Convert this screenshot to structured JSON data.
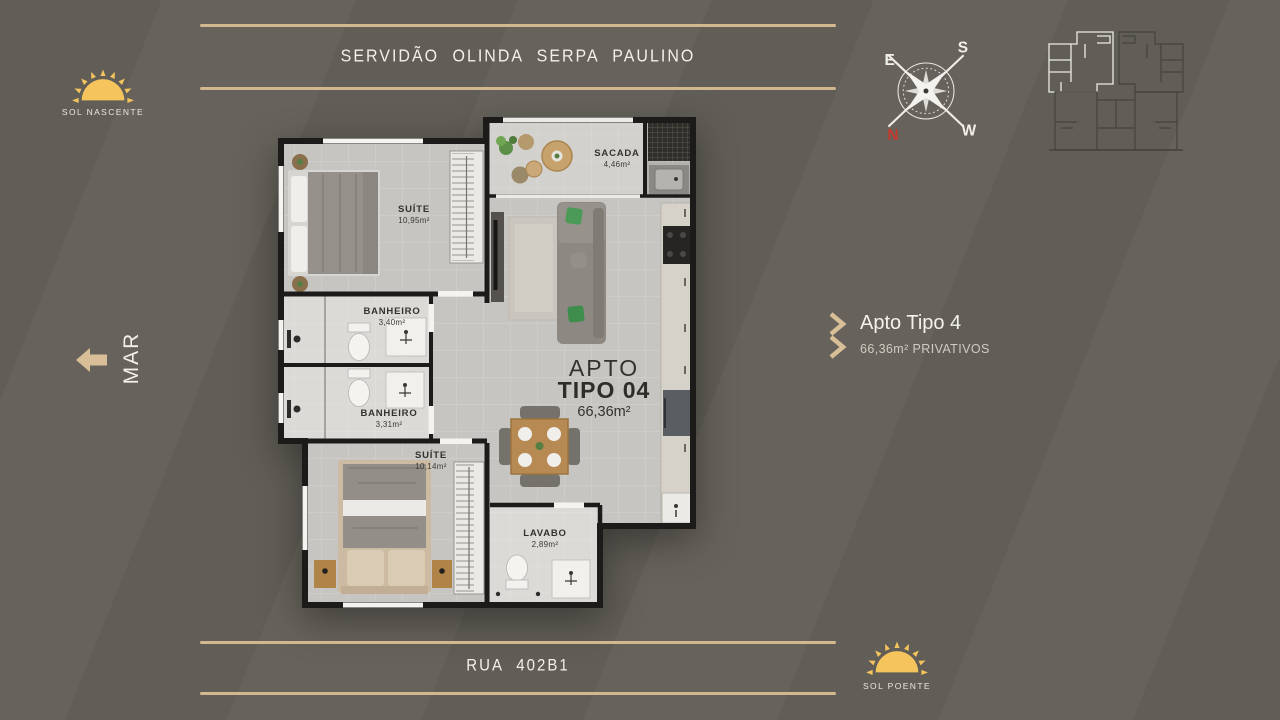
{
  "header": {
    "street": "SERVIDÃO OLINDA SERPA PAULINO"
  },
  "footer": {
    "street": "RUA 402B1"
  },
  "suns": {
    "nascente": "SOL NASCENTE",
    "poente": "SOL POENTE"
  },
  "sea": {
    "label": "MAR"
  },
  "compass": {
    "e": "E",
    "s": "S",
    "w": "W",
    "n": "N"
  },
  "info": {
    "title": "Apto Tipo 4",
    "subtitle": "66,36m² PRIVATIVOS"
  },
  "plan": {
    "apto": {
      "line1": "APTO",
      "line2": "TIPO 04",
      "area": "66,36m²"
    },
    "rooms": [
      {
        "name": "SUÍTE",
        "area": "10,95m²"
      },
      {
        "name": "SACADA",
        "area": "4,46m²"
      },
      {
        "name": "BANHEIRO",
        "area": "3,40m²"
      },
      {
        "name": "BANHEIRO",
        "area": "3,31m²"
      },
      {
        "name": "SUÍTE",
        "area": "10,14m²"
      },
      {
        "name": "LAVABO",
        "area": "2,89m²"
      }
    ]
  },
  "colors": {
    "accent_tan": "#d2b88f",
    "sun_yellow": "#f6c45c",
    "north_red": "#c3392c",
    "background": "#67635c"
  }
}
